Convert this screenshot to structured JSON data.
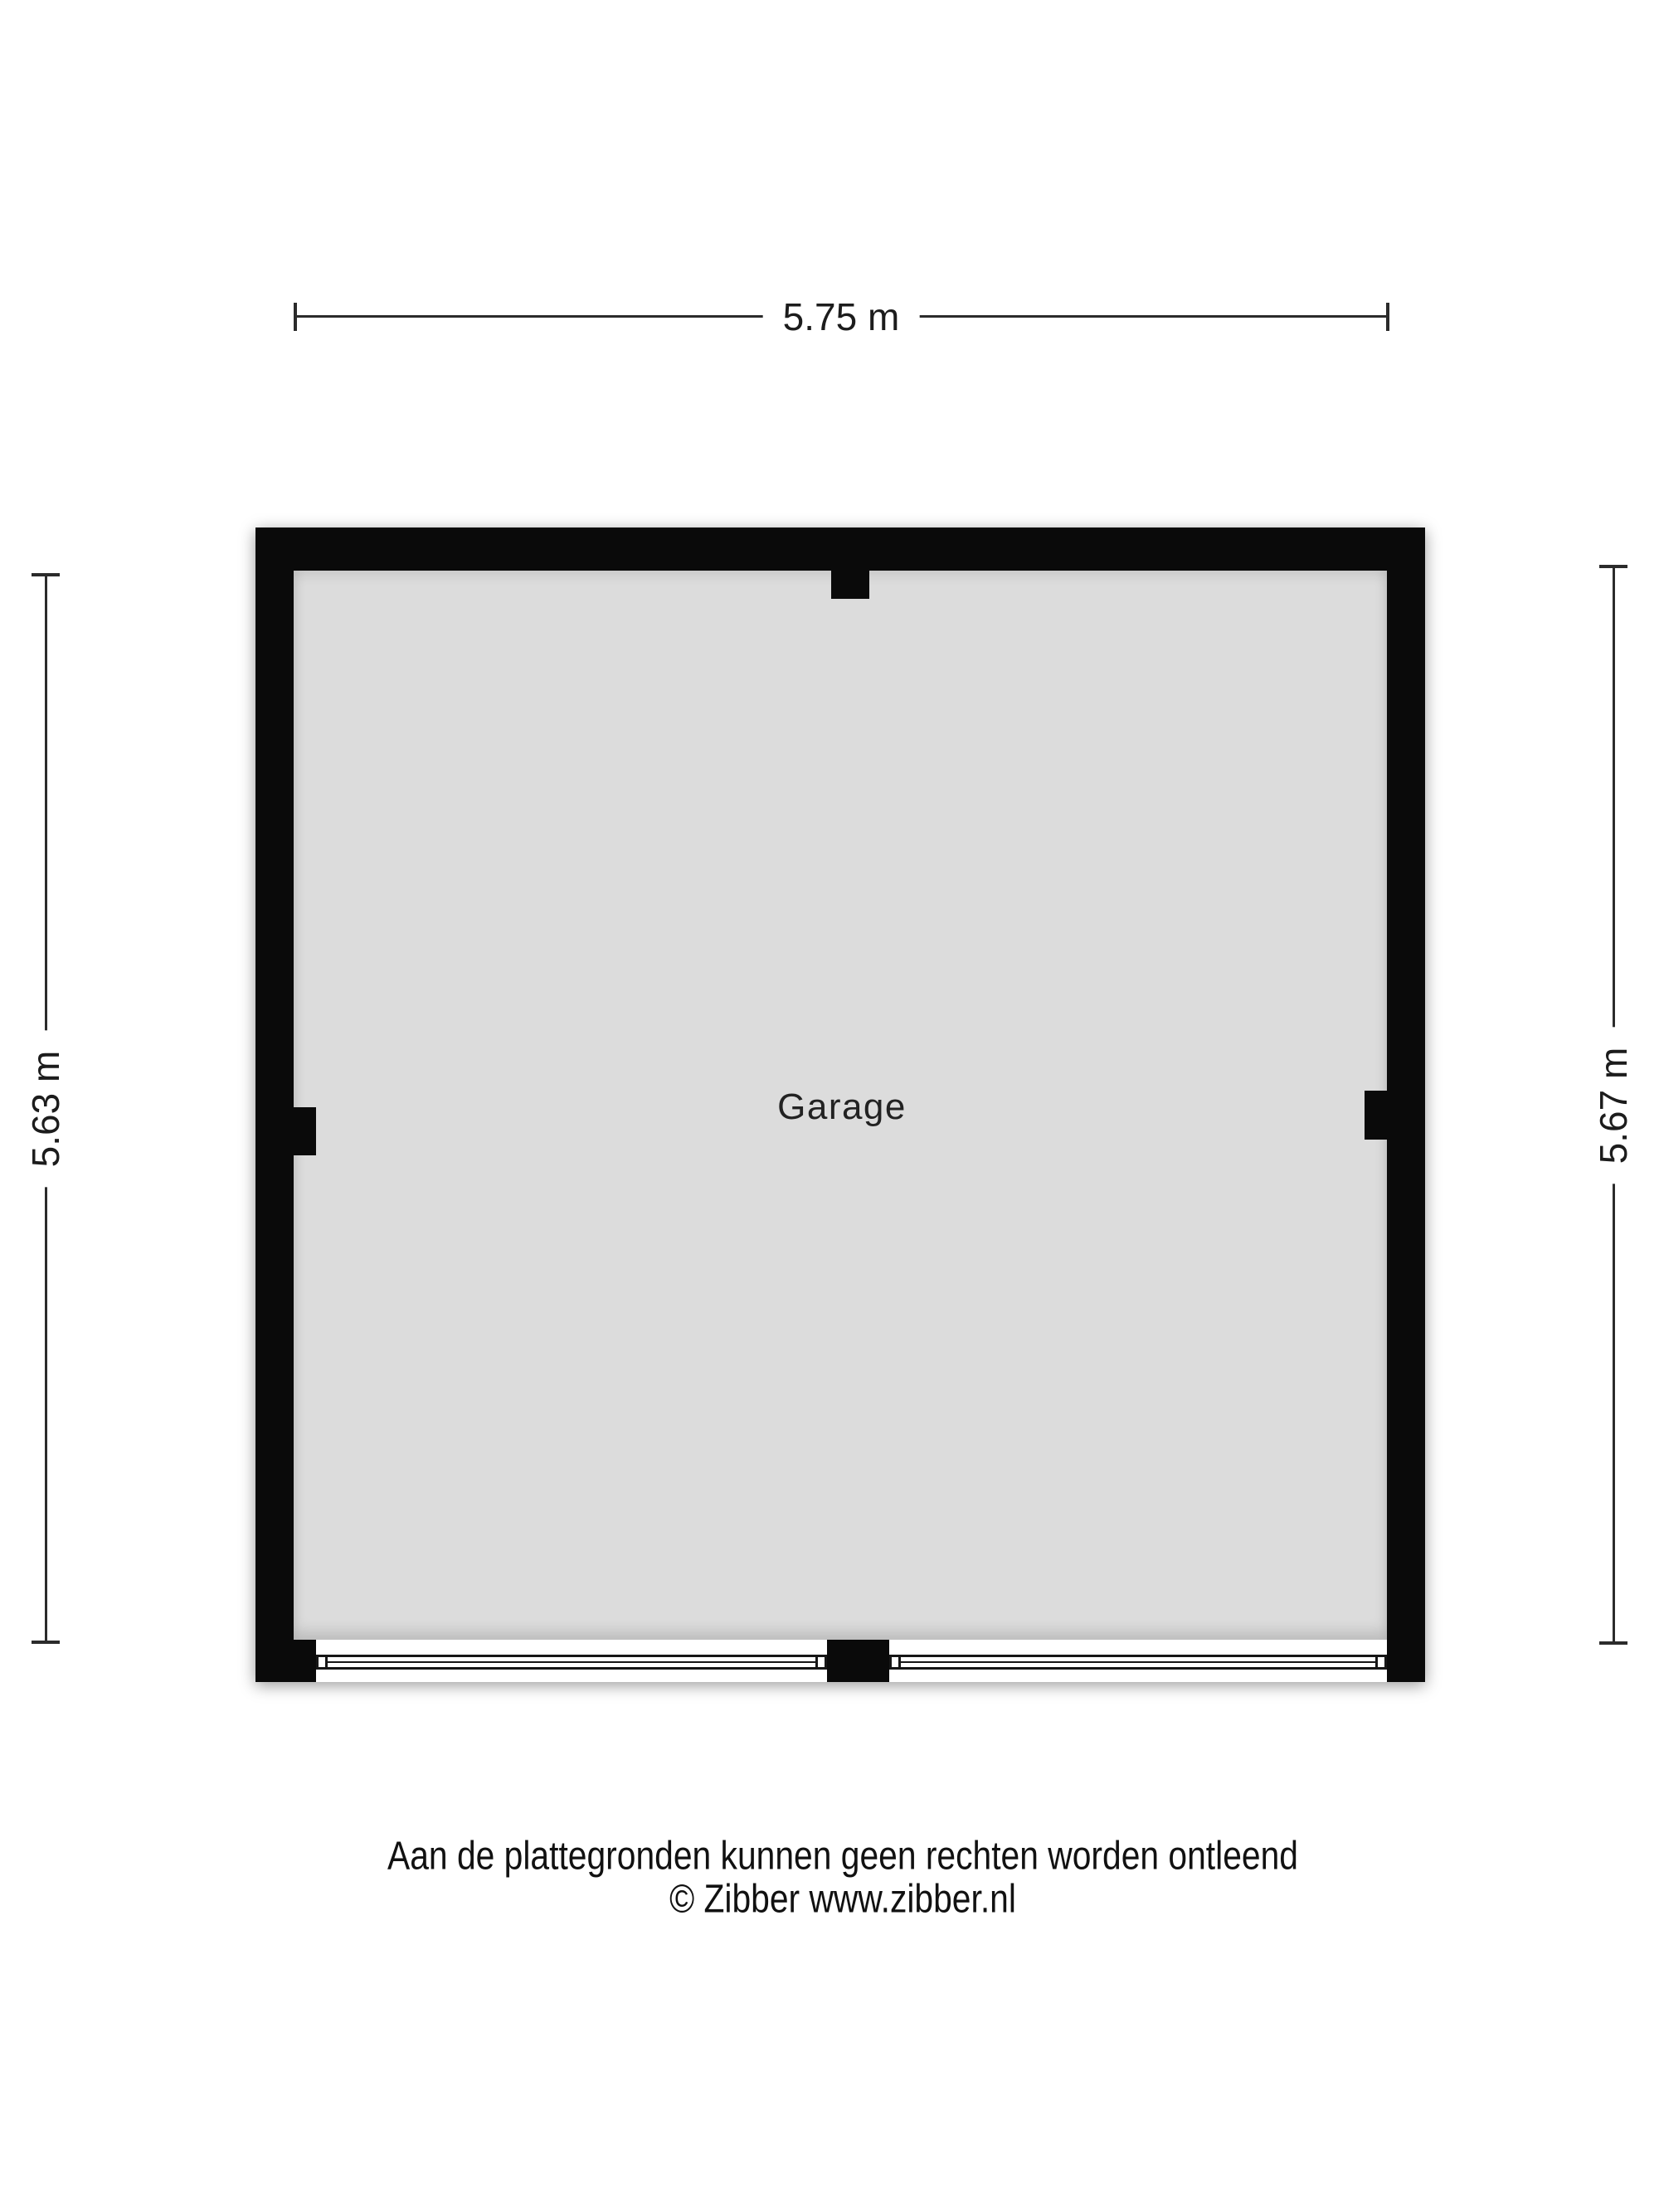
{
  "dimensions": {
    "top": {
      "label": "5.75 m"
    },
    "left": {
      "label": "5.63 m"
    },
    "right": {
      "label": "5.67 m"
    }
  },
  "room": {
    "label": "Garage"
  },
  "footer": {
    "disclaimer": "Aan de plattegronden kunnen geen rechten worden ontleend",
    "copyright": "© Zibber www.zibber.nl"
  },
  "colors": {
    "wall": "#0a0a0a",
    "floor": "#dcdcdc",
    "dimension_line": "#2b2b2b",
    "text": "#1c1c1c",
    "background": "#ffffff"
  }
}
